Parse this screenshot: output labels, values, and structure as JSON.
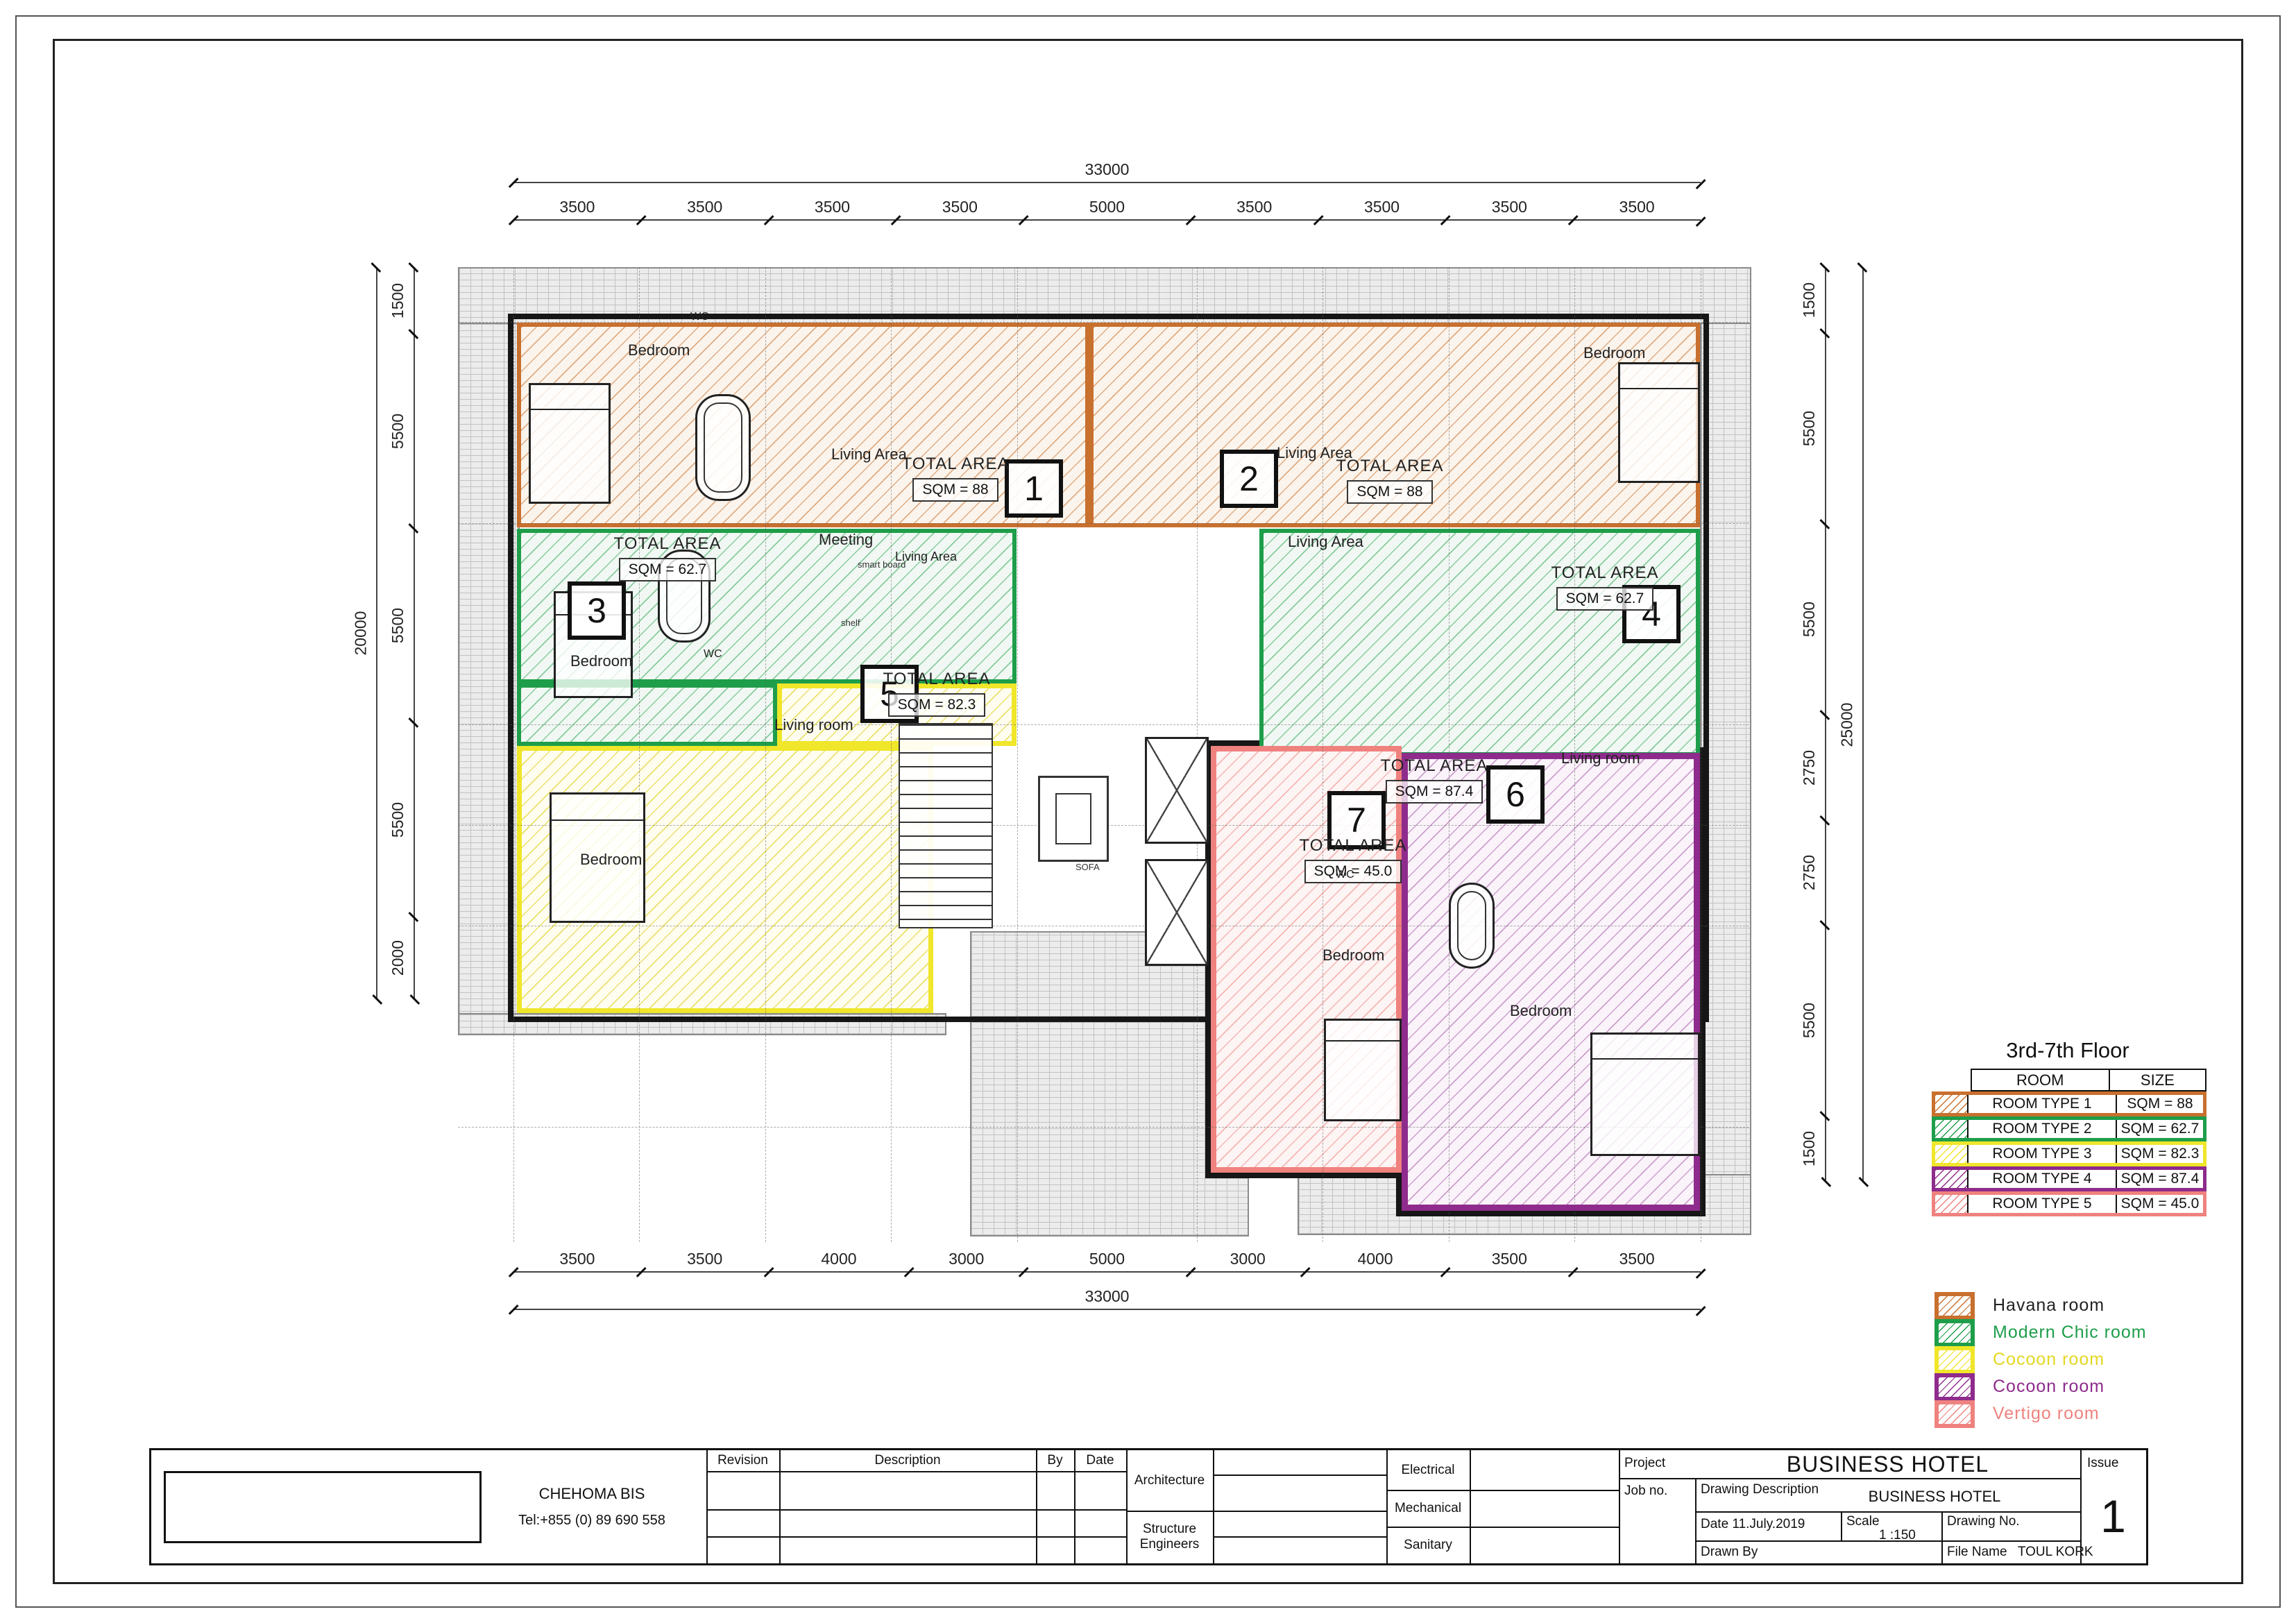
{
  "drawing": {
    "floor_title": "3rd-7th Floor",
    "sofa_note": "SOFA"
  },
  "rooms": [
    {
      "badge": "1",
      "area_title": "TOTAL AREA",
      "sqm": "SQM = 88"
    },
    {
      "badge": "2",
      "area_title": "TOTAL AREA",
      "sqm": "SQM = 88"
    },
    {
      "badge": "3",
      "area_title": "TOTAL AREA",
      "sqm": "SQM = 62.7"
    },
    {
      "badge": "4",
      "area_title": "TOTAL AREA",
      "sqm": "SQM = 62.7"
    },
    {
      "badge": "5",
      "area_title": "TOTAL AREA",
      "sqm": "SQM = 82.3"
    },
    {
      "badge": "6",
      "area_title": "TOTAL AREA",
      "sqm": "SQM = 87.4"
    },
    {
      "badge": "7",
      "area_title": "TOTAL AREA",
      "sqm": "SQM = 45.0"
    }
  ],
  "labels": {
    "bedroom1": "Bedroom",
    "wc1": "WC",
    "living1": "Living Area",
    "living2": "Living Area",
    "bedroom2": "Bedroom",
    "bedroom3": "Bedroom",
    "wc3": "WC",
    "meeting3": "Meeting",
    "living3": "Living Area",
    "smartboard3": "smart board",
    "shelf3": "shelf",
    "living4": "Living Area",
    "living5": "Living room",
    "bedroom5": "Bedroom",
    "living6": "Living room",
    "bedroom6": "Bedroom",
    "bedroom7": "Bedroom",
    "wc7": "WC",
    "sofa": "SOFA"
  },
  "dimensions": {
    "top": {
      "total": "33000",
      "segments": [
        "3500",
        "3500",
        "3500",
        "3500",
        "5000",
        "3500",
        "3500",
        "3500",
        "3500"
      ]
    },
    "bottom": {
      "total": "33000",
      "segments": [
        "3500",
        "3500",
        "4000",
        "3000",
        "5000",
        "3000",
        "4000",
        "3500",
        "3500"
      ]
    },
    "left": {
      "total": "20000",
      "segments": [
        "1500",
        "5500",
        "5500",
        "5500",
        "2000"
      ]
    },
    "right": {
      "total": "25000",
      "segments": [
        "1500",
        "5500",
        "5500",
        "2750",
        "2750",
        "5500",
        "1500"
      ]
    }
  },
  "legend": {
    "title": "3rd-7th Floor",
    "headers": {
      "room": "ROOM",
      "size": "SIZE"
    },
    "rows": [
      {
        "room": "ROOM TYPE 1",
        "size": "SQM = 88",
        "color": "#c8702e"
      },
      {
        "room": "ROOM TYPE 2",
        "size": "SQM = 62.7",
        "color": "#1e9e4a"
      },
      {
        "room": "ROOM TYPE 3",
        "size": "SQM = 82.3",
        "color": "#f0e62a"
      },
      {
        "room": "ROOM TYPE 4",
        "size": "SQM = 87.4",
        "color": "#8e2b8c"
      },
      {
        "room": "ROOM TYPE 5",
        "size": "SQM = 45.0",
        "color": "#ef827e"
      }
    ]
  },
  "room_key": {
    "items": [
      {
        "label": "Havana room",
        "color": "#c8702e",
        "text_color": "#222222"
      },
      {
        "label": "Modern Chic room",
        "color": "#1e9e4a",
        "text_color": "#1e9e4a"
      },
      {
        "label": "Cocoon room",
        "color": "#f0e62a",
        "text_color": "#e3d824"
      },
      {
        "label": "Cocoon room",
        "color": "#8e2b8c",
        "text_color": "#8e2b8c"
      },
      {
        "label": "Vertigo room",
        "color": "#ef827e",
        "text_color": "#ef827e"
      }
    ]
  },
  "title_block": {
    "company": "CHEHOMA BIS",
    "tel": "Tel:+855 (0) 89 690 558",
    "revision": "Revision",
    "description": "Description",
    "by": "By",
    "date_col": "Date",
    "architecture": "Architecture",
    "structure": "Structure Engineers",
    "electrical": "Electrical",
    "mechanical": "Mechanical",
    "sanitary": "Sanitary",
    "project_label": "Project",
    "project_name": "BUSINESS HOTEL",
    "job_no": "Job no.",
    "drawing_description_label": "Drawing Description",
    "drawing_description": "BUSINESS HOTEL",
    "date_label": "Date",
    "date_value": "11.July.2019",
    "scale_label": "Scale",
    "scale_value": "1 :150",
    "drawing_no_label": "Drawing No.",
    "drawn_by_label": "Drawn By",
    "file_name_label": "File Name",
    "file_name": "TOUL KORK",
    "issue_label": "Issue",
    "issue_value": "1"
  }
}
